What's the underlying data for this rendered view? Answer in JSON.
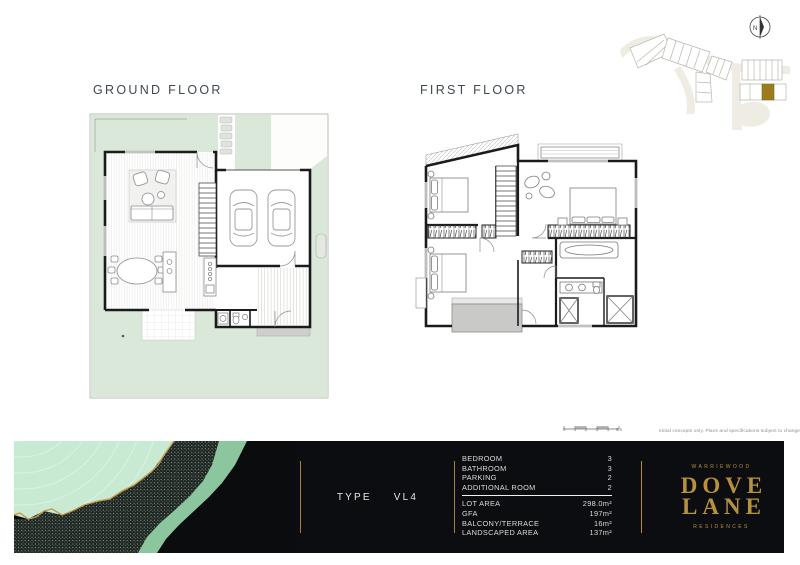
{
  "page": {
    "ground_title": "GROUND FLOOR",
    "first_title": "FIRST FLOOR",
    "disclaimer": "Initial concepts only. Plans and specifications subject to change.",
    "scale": {
      "labels": [
        "0",
        "1",
        "2",
        "3",
        "4",
        "5m"
      ]
    }
  },
  "site_map": {
    "compass_label": "N",
    "highlight_color": "#9c7a1e"
  },
  "footer": {
    "type": {
      "label": "TYPE",
      "value": "VL4"
    },
    "counts": [
      {
        "label": "BEDROOM",
        "value": "3"
      },
      {
        "label": "BATHROOM",
        "value": "3"
      },
      {
        "label": "PARKING",
        "value": "2"
      },
      {
        "label": "ADDITIONAL ROOM",
        "value": "2"
      }
    ],
    "areas": [
      {
        "label": "LOT AREA",
        "value": "298.0m²"
      },
      {
        "label": "GFA",
        "value": "197m²"
      },
      {
        "label": "BALCONY/TERRACE",
        "value": "16m²"
      },
      {
        "label": "LANDSCAPED AREA",
        "value": "137m²"
      }
    ],
    "brand": {
      "location": "WARRIEWOOD",
      "name_line1": "DOVE",
      "name_line2": "LANE",
      "descriptor": "RESIDENCES"
    }
  },
  "colors": {
    "brand_gold": "#b8913c",
    "footer_bg": "#0b0d10",
    "plan_green": "#d9e8d8",
    "artwork_mint": "#c8ead3",
    "artwork_river": "#8bc69e",
    "lot_highlight": "#9c7a1e"
  }
}
